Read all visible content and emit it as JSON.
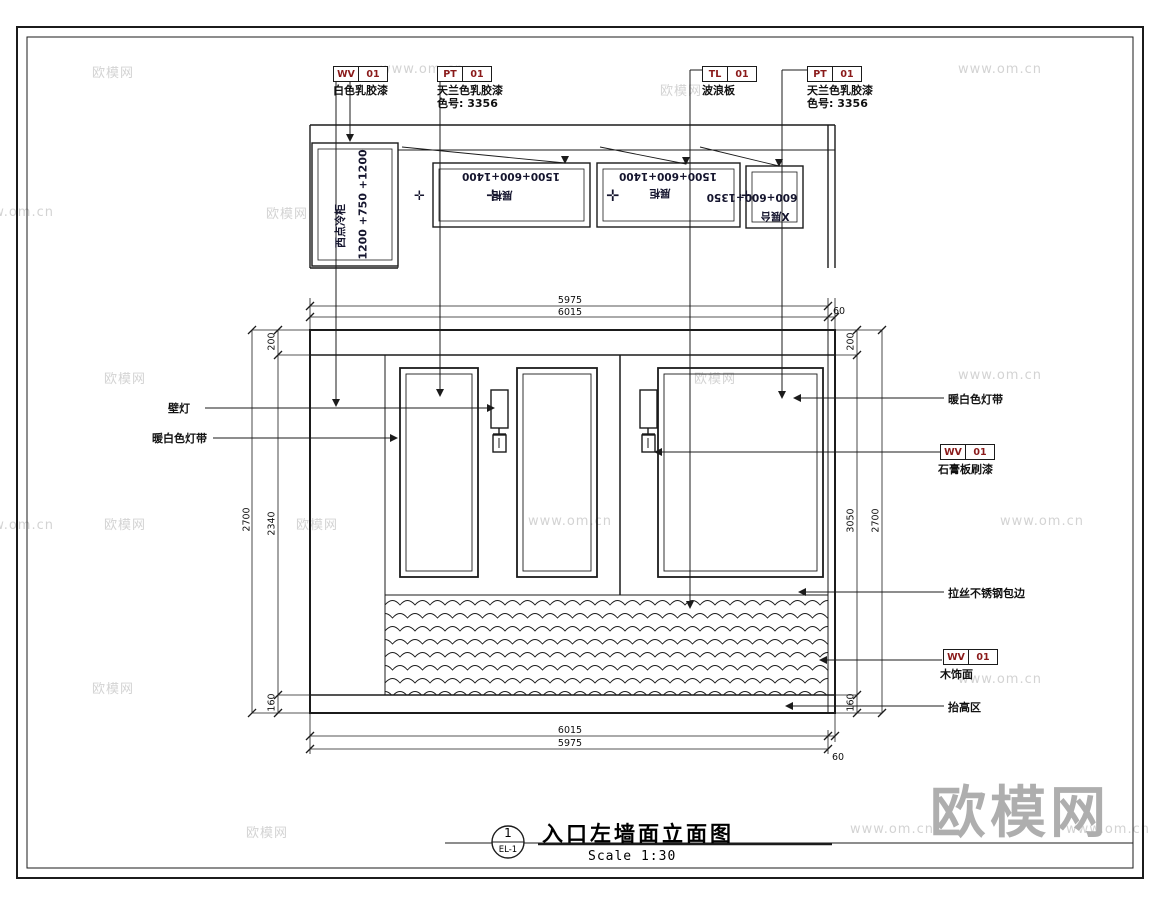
{
  "watermark": {
    "brand": "欧模网",
    "url": "www.om.cn"
  },
  "tags": {
    "wv_paint": {
      "code": "WV",
      "num": "01",
      "caption": "白色乳胶漆"
    },
    "pt_left": {
      "code": "PT",
      "num": "01",
      "caption": "天兰色乳胶漆",
      "color_no": "色号: 3356"
    },
    "tl": {
      "code": "TL",
      "num": "01",
      "caption": "波浪板"
    },
    "pt_right": {
      "code": "PT",
      "num": "01",
      "caption": "天兰色乳胶漆",
      "color_no": "色号: 3356"
    },
    "wv_gypsum": {
      "code": "WV",
      "num": "01",
      "caption": "石膏板刷漆"
    },
    "wv_wood": {
      "code": "WV",
      "num": "01",
      "caption": "木饰面"
    }
  },
  "plan": {
    "cabinet_size": "1200 +750 +1200",
    "cabinet_label": "西点冷柜",
    "case1_size": "1500+600+1400",
    "case1_label": "展柜",
    "case2_size": "1500+600+1400",
    "case2_label": "展柜",
    "case3_size": "600+600+1350",
    "case3_label": "X展台",
    "light_symbol": "✛"
  },
  "callouts": {
    "wall_lamp": "壁灯",
    "led_left": "暖白色灯带",
    "led_right": "暖白色灯带",
    "steel": "拉丝不锈钢包边",
    "base": "抬高区"
  },
  "dims": {
    "top_a": "5975",
    "top_b": "6015",
    "top_c": "60",
    "bottom_a": "6015",
    "bottom_b": "5975",
    "bottom_c": "60",
    "left_total": "2700",
    "left_top": "200",
    "left_mid": "2340",
    "left_base": "160",
    "right_top": "200",
    "right_mid": "3050",
    "right_total": "2700",
    "right_base": "160"
  },
  "title_block": {
    "num": "1",
    "sheet": "EL-1",
    "title": "入口左墙面立面图",
    "scale": "Scale 1:30"
  }
}
